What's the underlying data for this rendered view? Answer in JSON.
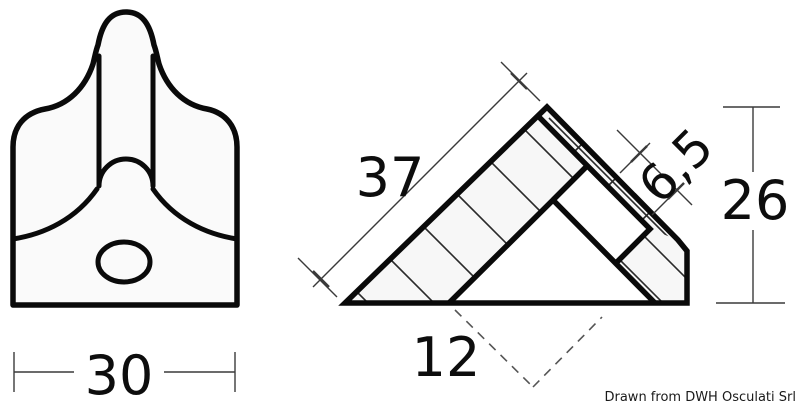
{
  "page": {
    "background": "#ffffff"
  },
  "caption": {
    "text": "Drawn from DWH Osculati Srl",
    "color": "#1a1a1a"
  },
  "views": {
    "front": {
      "description": "front view of molded corner piece with oval hole",
      "dim_width": "30"
    },
    "section": {
      "description": "45-degree corner profile cross-section with hatched flanges",
      "dim_hypotenuse": "37",
      "dim_flange": "6,5",
      "dim_height": "26",
      "dim_base": "12"
    }
  },
  "colors": {
    "outline": "#0a0a0a",
    "thin_line": "#3a3a3a",
    "hatch_line": "#2a2a2a",
    "dashed_line": "#555555",
    "fill_light": "#f7f7f7",
    "fill_white": "#ffffff"
  }
}
